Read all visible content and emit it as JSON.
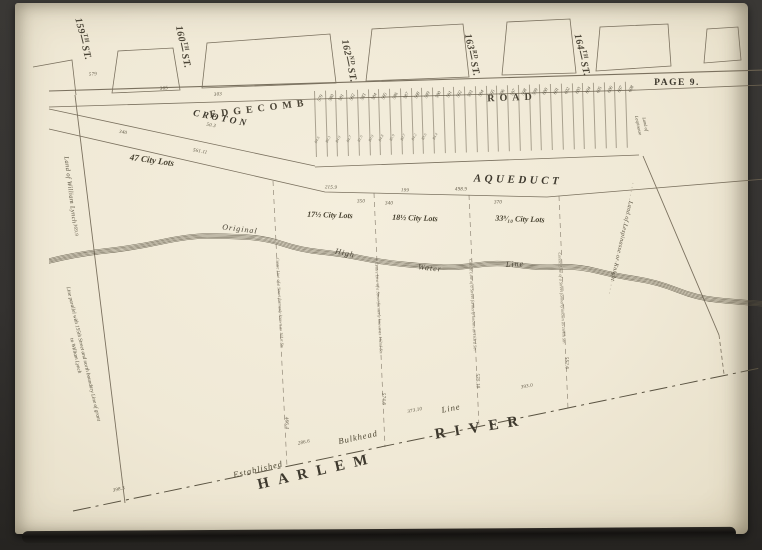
{
  "colors": {
    "paper": "#f0e9d6",
    "ink": "#453f32",
    "line": "#6e6452",
    "surround": "#343230"
  },
  "header": {
    "page_label": "PAGE 9."
  },
  "streets": [
    {
      "number": "159",
      "ordinal": "TH",
      "suffix": "ST."
    },
    {
      "number": "160",
      "ordinal": "TH",
      "suffix": "ST."
    },
    {
      "number": "162",
      "ordinal": "ND",
      "suffix": "ST."
    },
    {
      "number": "163",
      "ordinal": "RD",
      "suffix": "ST."
    },
    {
      "number": "164",
      "ordinal": "TH",
      "suffix": "ST."
    }
  ],
  "road": {
    "name_left": "EDGECOMB",
    "name_right": "ROAD"
  },
  "aqueduct": {
    "upper": "CROTON",
    "lower": "AQUEDUCT"
  },
  "city_lots": [
    "47 City Lots",
    "17½ City Lots",
    "18½ City Lots",
    "33⁹⁄₁₀ City Lots"
  ],
  "water_line": {
    "w1": "Original",
    "w2": "High",
    "w3": "Water",
    "w4": "Line"
  },
  "river": {
    "w1": "HARLEM",
    "w2": "RIVER"
  },
  "bulkhead": {
    "w1": "Established",
    "w2": "Bulkhead",
    "w3": "Line"
  },
  "boundaries": {
    "lynch": "Land of William Lynch",
    "lynch_note_1": "Line parallel with 155th Street and north boundary Line of grant",
    "lynch_note_2": "to William Lynch",
    "lespinasse_small_1": "Land of",
    "lespinasse_small_2": "Lespinasse",
    "lespinasse": "Land of Lespinasse or Knight"
  },
  "street_lines": [
    {
      "label": "Centre Line of a Street formerly known as 161st Str.",
      "num": "466.4"
    },
    {
      "label": "Centre Line of a Street formerly known as 162nd Str.",
      "num": "574.6"
    },
    {
      "label": "Centre Line of a Street formerly known as 163rd Str.",
      "num": "575.10"
    },
    {
      "label": "Centre Line of a Street formerly known as 164th Str.",
      "num": "552.6"
    }
  ],
  "measurements": {
    "road_579": "579",
    "road_365": "365",
    "road_303": "303",
    "road_50": "50.3",
    "croton_340": "340",
    "aqueduct_561": "561.11",
    "sec_215": "215.9",
    "sec_199": "199",
    "sec_498": "498.9",
    "par_350": "350",
    "par_340": "340",
    "par_370": "370",
    "lynch_369": "369.9",
    "bh_398": "398.3",
    "bh_286": "286.6",
    "bh_373": "373.10",
    "bh_393": "393.0"
  },
  "lot_strip": {
    "lots": [
      {
        "n": "579",
        "d": "84.6"
      },
      {
        "n": "580",
        "d": "80.3"
      },
      {
        "n": "581",
        "d": "84.9"
      },
      {
        "n": "582",
        "d": "84.7"
      },
      {
        "n": "583",
        "d": "81.6"
      },
      {
        "n": "584",
        "d": "80.9"
      },
      {
        "n": "585",
        "d": "84.8"
      },
      {
        "n": "586",
        "d": "85.9"
      },
      {
        "n": "587",
        "d": "80.7"
      },
      {
        "n": "588",
        "d": "84.2"
      },
      {
        "n": "589",
        "d": "83.6"
      },
      {
        "n": "590",
        "d": "84.4"
      },
      {
        "n": "591",
        "d": ""
      },
      {
        "n": "592",
        "d": ""
      },
      {
        "n": "593",
        "d": ""
      },
      {
        "n": "594",
        "d": ""
      },
      {
        "n": "595",
        "d": ""
      },
      {
        "n": "596",
        "d": ""
      },
      {
        "n": "597",
        "d": ""
      },
      {
        "n": "598",
        "d": ""
      },
      {
        "n": "599",
        "d": ""
      },
      {
        "n": "600",
        "d": ""
      },
      {
        "n": "601",
        "d": ""
      },
      {
        "n": "602",
        "d": ""
      },
      {
        "n": "603",
        "d": ""
      },
      {
        "n": "604",
        "d": ""
      },
      {
        "n": "605",
        "d": ""
      },
      {
        "n": "606",
        "d": ""
      },
      {
        "n": "607",
        "d": ""
      },
      {
        "n": "608",
        "d": ""
      }
    ]
  }
}
